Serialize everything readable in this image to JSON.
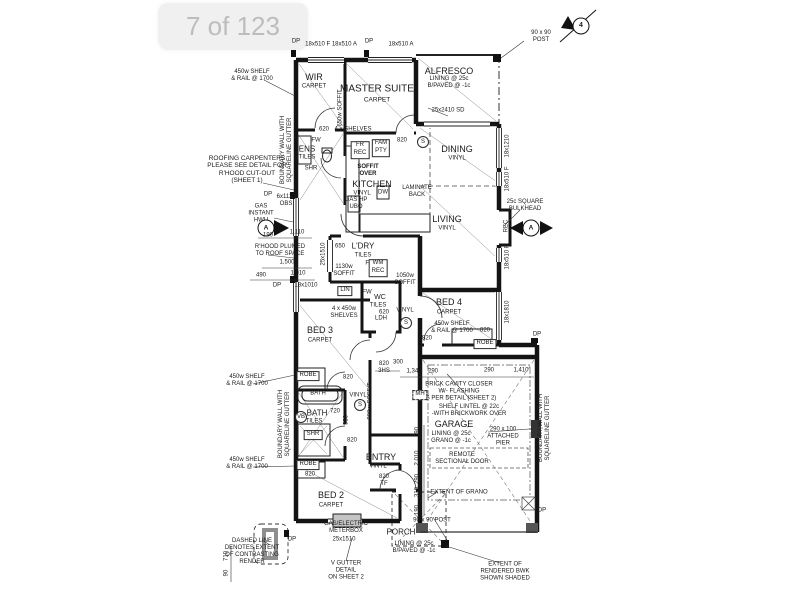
{
  "overlay": {
    "page_indicator": "7 of 123"
  },
  "compass": {
    "label": "4"
  },
  "rooms": {
    "wir": {
      "name": "WIR",
      "finish": "CARPET"
    },
    "master": {
      "name": "MASTER SUITE",
      "finish": "CARPET"
    },
    "alfresco": {
      "name": "ALFRESCO",
      "spec": "LINING @ 25c\nB/PAVED @ -1c"
    },
    "dining": {
      "name": "DINING",
      "finish": "VINYL"
    },
    "kitchen": {
      "name": "KITCHEN",
      "finish": "VINYL"
    },
    "living": {
      "name": "LIVING",
      "finish": "VINYL"
    },
    "ens": {
      "name": "ENS",
      "finish": "TILES"
    },
    "ldry": {
      "name": "L'DRY",
      "finish": "TILES"
    },
    "wc": {
      "name": "WC",
      "finish": "TILES"
    },
    "bed3": {
      "name": "BED 3",
      "finish": "CARPET"
    },
    "bath": {
      "name": "BATH",
      "finish": "TILES"
    },
    "bed2": {
      "name": "BED 2",
      "finish": "CARPET"
    },
    "bed4": {
      "name": "BED 4",
      "finish": "CARPET"
    },
    "entry": {
      "name": "ENTRY",
      "finish": "VINYL"
    },
    "garage": {
      "name": "GARAGE",
      "spec": "LINING @ 25c\nGRANO @ -1c"
    },
    "porch": {
      "name": "PORCH",
      "spec": "LINING @ 25c\nB/PAVED @ -1c"
    },
    "hall_upper_finish": "VINYL",
    "hall_lower_finish": "VINYL"
  },
  "notes": {
    "shelf_rail": "450w SHELF\n& RAIL @ 1700",
    "boundary_wall": "BOUNDARY WALL WITH\nSQUARELINE GUTTER",
    "roofing": "ROOFING CARPENTERS\nPLEASE SEE DETAIL FOR\nR'HOOD CUT-OUT\n(SHEET 1)",
    "gas_instant": "GAS\nINSTANT\nHWU",
    "rhood": "R'HOOD PLUMED\nTO ROOF SPACE",
    "laminate": "LAMINATE\nBACK",
    "soffit_over": "SOFFIT\nOVER",
    "bulkhead": "25c SQUARE\nBULKHEAD",
    "post_90": "90 x 90\nPOST",
    "post_90_inline": "90 x 90 POST",
    "brick_cavity": "BRICK CAVITY CLOSER\nW/- FLASHING\nAS PER DETAIL (SHEET 2)",
    "shelf_lintel": "SHELF LINTEL @ 22c\n-WITH BRICKWORK OVER",
    "attached_pier": "290 x 100\nATTACHED\nPIER",
    "remote_door": "REMOTE\nSECTIONAL DOOR",
    "extent_grano": "EXTENT OF GRANO",
    "meterbox": "GAS/ELECTRIC\nMETERBOX",
    "dashed_render": "DASHED LINE\nDENOTES EXTENT\nOF CONTRASTING\nRENDER",
    "v_gutter": "V GUTTER\nDETAIL\nON SHEET 2",
    "extent_bwk": "EXTENT OF\nRENDERED BWK\nSHOWN SHADED",
    "shelves_4": "4 x SHELVES",
    "shelves_450": "4 x 450w\nSHELVES"
  },
  "openings": {
    "w_top1": "18x510 F  18x510 A",
    "w_top2": "18x510 A",
    "sd_alfresco": "25x2410 SD",
    "w_dining": "18x1210",
    "w_living1": "18x510 F",
    "w_living2": "18x510 F",
    "w_bed4": "18x1810",
    "w_obs": "6x1110\nOBS",
    "w_1010": "18x1010",
    "sd_ldry": "25x1510",
    "sd_bed2": "25x1510",
    "d620": "620",
    "d650": "650",
    "d820": "820",
    "d820tf": "820\nTF",
    "d820_3hs": "820\n3HS",
    "d720": "720",
    "d930": "930",
    "dp": "DP"
  },
  "dims": {
    "d190": "190",
    "d1110": "1,110",
    "d1500": "1,500",
    "d490": "490",
    "d1010": "1,010",
    "d300": "300",
    "d1340": "1,340",
    "d290": "290",
    "d1410": "1,410",
    "d2010": "2,010",
    "d310": "310",
    "d710": "710",
    "d90": "90"
  },
  "fixtures": {
    "robe": "ROBE",
    "lin": "LIN",
    "shr": "SHR",
    "bath_tub": "BATH",
    "wm": "WM\nREC",
    "fr": "FR\nREC",
    "fam": "FAM\nPTY",
    "fw": "FW",
    "dw": "DW",
    "gas_hp": "GAS HP\nUBO",
    "mh": "MH",
    "vb": "VB",
    "rec": "REC",
    "s": "S",
    "a": "A",
    "wc_620": "620",
    "ldh": "LDH",
    "soffit_1130": "1130w\nSOFFIT",
    "soffit_1050": "1050w\nSOFFIT",
    "soffit_900": "900w SOFFIT",
    "soffit_650": "650w SOFFIT"
  }
}
